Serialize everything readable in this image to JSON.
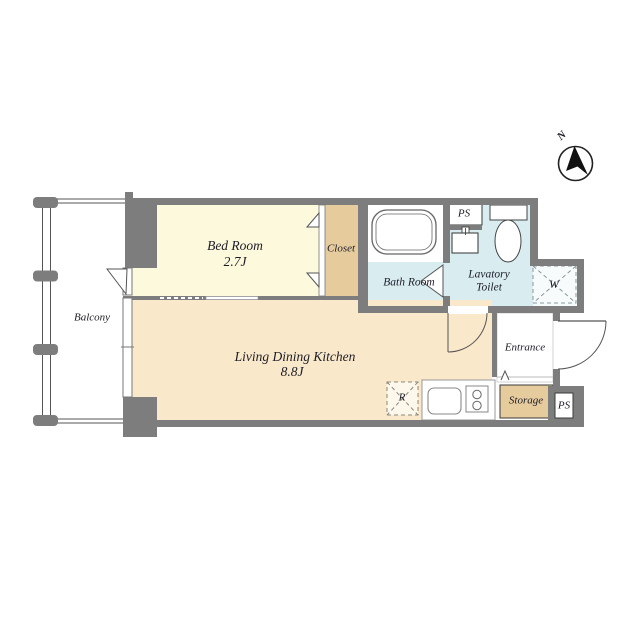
{
  "plan": {
    "compass": {
      "north_label": "N"
    },
    "balcony": {
      "label": "Balcony"
    },
    "bedroom": {
      "label": "Bed Room",
      "area": "2.7J"
    },
    "closet": {
      "label": "Closet"
    },
    "bathroom": {
      "label": "Bath Room"
    },
    "lavatory": {
      "label_line1": "Lavatory",
      "label_line2": "Toilet"
    },
    "ldk": {
      "label": "Living Dining Kitchen",
      "area": "8.8J"
    },
    "entrance": {
      "label": "Entrance"
    },
    "storage": {
      "label": "Storage"
    },
    "pipe_space_top": {
      "label": "PS"
    },
    "pipe_space_bottom": {
      "label": "PS"
    },
    "washer_space": {
      "label": "W"
    },
    "refrigerator_space": {
      "label": "R"
    },
    "colors": {
      "wall": "#7d7d7d",
      "bedroom_floor": "#fcf9dd",
      "ldk_floor": "#f9e8c9",
      "closet_floor": "#e6cb9c",
      "wet_area_floor": "#d9edf1",
      "fixture_outline": "#555555",
      "text": "#1d1d28"
    }
  }
}
